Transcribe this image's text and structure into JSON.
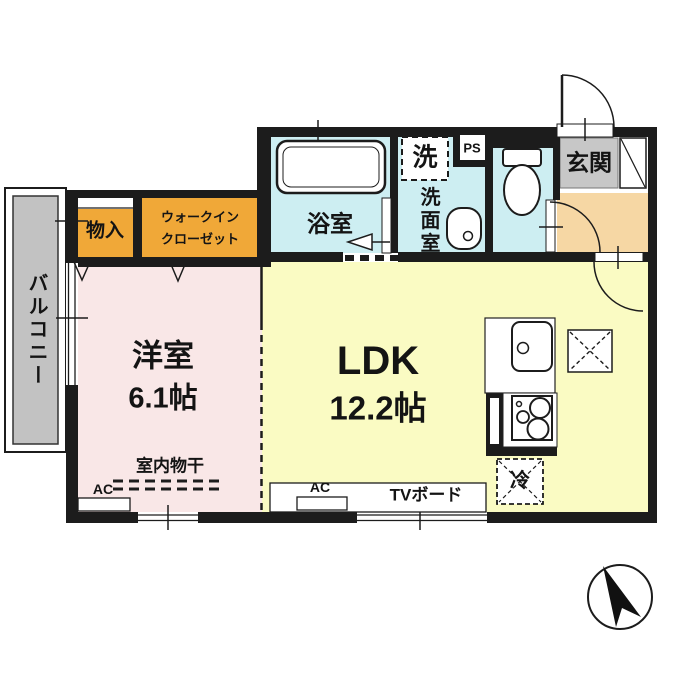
{
  "plan": {
    "rooms": {
      "western_room": {
        "label": "洋室",
        "size": "6.1帖"
      },
      "ldk": {
        "label": "LDK",
        "size": "12.2帖"
      },
      "bathroom": {
        "label": "浴室"
      },
      "washroom": {
        "label": "洗面室"
      },
      "laundry_space": {
        "label": "洗"
      },
      "pipe_space": {
        "label": "PS"
      },
      "entrance": {
        "label": "玄関"
      },
      "storage": {
        "label": "物入"
      },
      "walk_in_closet": {
        "label_line1": "ウォークイン",
        "label_line2": "クローゼット"
      },
      "balcony": {
        "label": "バルコニー"
      }
    },
    "fixtures": {
      "indoor_drying": {
        "label": "室内物干"
      },
      "ac_bedroom": {
        "label": "AC"
      },
      "ac_ldk": {
        "label": "AC"
      },
      "tv_board": {
        "label": "TVボード"
      },
      "refrigerator": {
        "label": "冷"
      }
    },
    "colors": {
      "wall": "#1c1c1c",
      "western_room_floor": "#f9e7e7",
      "ldk_floor": "#fafbc3",
      "wet_area_floor": "#cdeef2",
      "closet_fill": "#f0a838",
      "hallway_floor": "#f6d7a4",
      "entrance_floor": "#c7c7c7",
      "balcony_floor": "#c2c2c2"
    }
  }
}
